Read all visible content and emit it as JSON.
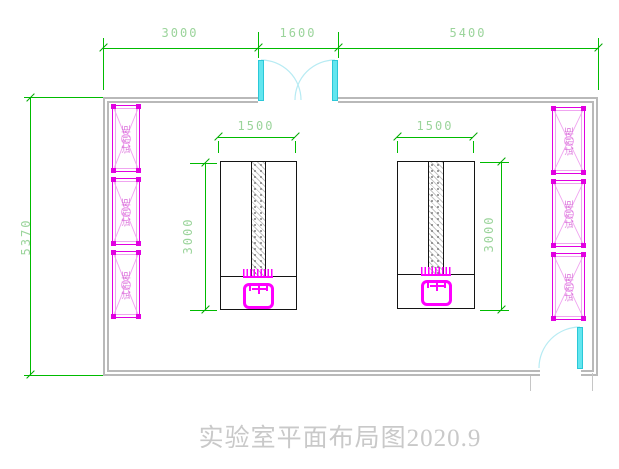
{
  "title": "实验室平面布局图2020.9",
  "dimensions": {
    "top_left": "3000",
    "top_middle": "1600",
    "top_right": "5400",
    "left_overall": "5370",
    "bench_left_width": "1500",
    "bench_right_width": "1500",
    "bench_left_depth": "3000",
    "bench_right_depth": "3000"
  },
  "cabinets": {
    "left": [
      {
        "label": "试剂柜"
      },
      {
        "label": "试剂柜"
      },
      {
        "label": "试剂柜"
      }
    ],
    "right": [
      {
        "label": "试剂柜"
      },
      {
        "label": "试剂柜"
      },
      {
        "label": "试剂柜"
      }
    ]
  },
  "colors": {
    "dimension_line": "#00bb00",
    "dimension_text": "#9bd49b",
    "wall": "#b9b9b9",
    "cabinet": "#e100e1",
    "cabinet_light": "#f0a4f0",
    "sink": "#ff00ff",
    "door_leaf": "#63e6ef",
    "door_arc": "#b7ebf3",
    "bench_outline": "#141414",
    "title_text": "#c9c9c9"
  }
}
